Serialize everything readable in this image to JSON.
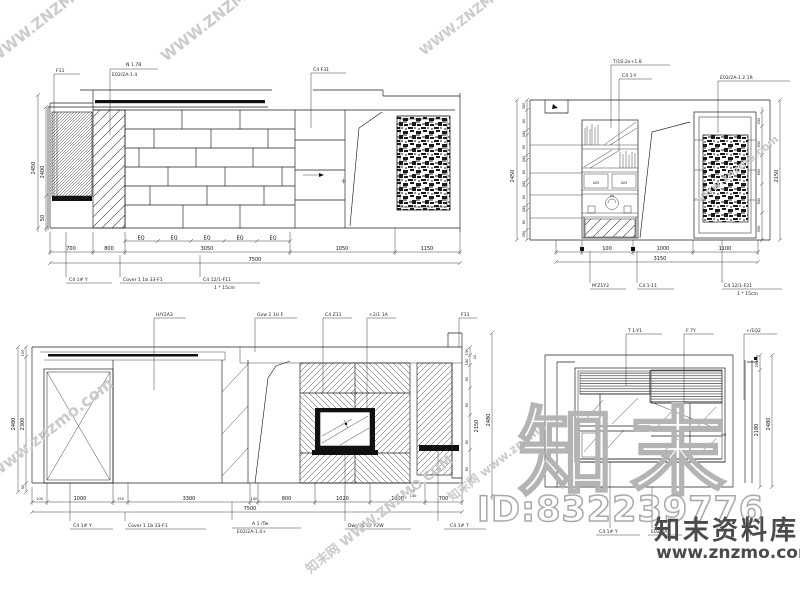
{
  "watermarks": {
    "brand_outline": "知末",
    "id_label": "ID:832239776",
    "brand_name": "知末资料库",
    "brand_url": "www.znzmo.com",
    "diag_upper": "WWW.ZNZMO.COM",
    "diag_lower": "www.znzmo.com",
    "diag_cjk": "知末网 WWW.ZNZMO.COM",
    "diag_cjk2": "知末网 www.znzmo"
  },
  "colors": {
    "line": "#1d1d1f",
    "watermark_light": "#cbcbcb",
    "watermark_outline": "#b4b4b4",
    "watermark_dark": "#4a4a4a",
    "paper": "#ffffff"
  },
  "tl": {
    "top_labels": [
      "F11",
      "N 1.7B",
      "E02/2A-1.4",
      "C4 F31"
    ],
    "eq_labels": [
      "EQ",
      "EQ",
      "EQ",
      "EQ",
      "EQ"
    ],
    "dims_bottom": [
      "700",
      "800",
      "3050",
      "1050",
      "1150"
    ],
    "dim_total": "7500",
    "dims_left": [
      "2450",
      "2400",
      "50"
    ],
    "bottom_labels": [
      "C4 1# Y",
      "Cover 1 1b 33-F1",
      "C4 12/1-F11",
      "1 * 15cm"
    ]
  },
  "tr": {
    "top_labels": [
      "T/1S-2x+1.8",
      "C4 1-Y",
      "E02/2A-1.2 1R"
    ],
    "dims_left": [
      "350",
      "60",
      "340",
      "60",
      "340",
      "60",
      "340",
      "60",
      "340",
      "60",
      "350"
    ],
    "left_total": "2450",
    "cell_dims": [
      "425",
      "425"
    ],
    "dims_right": [
      "250",
      "550",
      "550",
      "550",
      "550"
    ],
    "right_total": "2150",
    "dims_bottom": [
      "100",
      "1000",
      "1100"
    ],
    "dim_total": "3150",
    "bottom_labels": [
      "M'Z1Y2",
      "C4 1-11",
      "C4 12/1-F21",
      "1 * 15cm"
    ]
  },
  "bl": {
    "top_labels": [
      "H/Y2A3",
      "Gvw 1 1U F.",
      "C4 Z11",
      "+2/1 1A",
      "F11"
    ],
    "dims_left": [
      "100",
      "2300",
      "50"
    ],
    "left_total": "2480",
    "dims_right": [
      "150",
      "10",
      "140",
      "60",
      "60",
      "2150",
      "60",
      "60"
    ],
    "right_total": "2480",
    "dims_bottom": [
      "100",
      "1000",
      "150",
      "3300",
      "140",
      "800",
      "1020",
      "1000",
      "700"
    ],
    "small_dims": [
      "10",
      "140"
    ],
    "dim_total": "7500",
    "bottom_labels": [
      "C4 1# Y",
      "Cover 1 1b 33-F1",
      "A 1 /Tw",
      "E02/2A-1.4+",
      "Dwr/1S 12 Y2W",
      "C4 1# 7"
    ]
  },
  "br": {
    "top_labels": [
      "T 1-Y1",
      "F 7Y",
      "+/1Q2"
    ],
    "dims_right": [
      "255",
      "2180"
    ],
    "right_total": "2480",
    "pane_tags": [
      "50",
      "50"
    ],
    "bottom_labels": [
      "C4 1# Y",
      "E02/2A"
    ]
  }
}
